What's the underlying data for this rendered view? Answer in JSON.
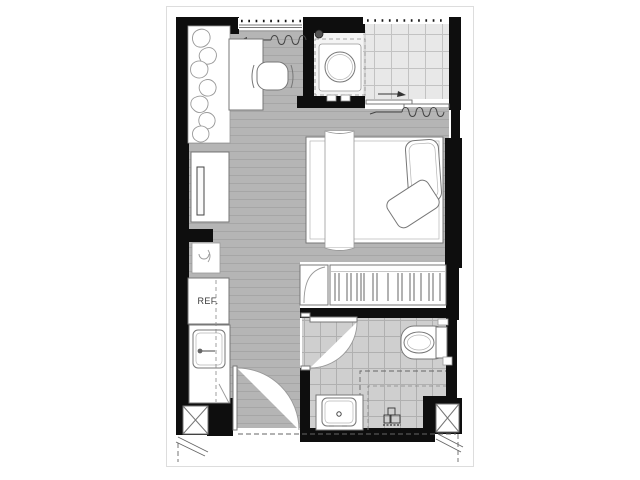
{
  "plan": {
    "ref_label": "REF.",
    "fixtures": [
      "sofa",
      "desk",
      "desk-chair",
      "tv-console",
      "tv-panel",
      "kitchen-cabinet",
      "refrigerator",
      "kitchen-sink-counter",
      "washing-machine",
      "balcony-tiles",
      "bed",
      "pillows",
      "blanket-runner",
      "wardrobe",
      "small-cabinet",
      "bathroom-door",
      "entry-door",
      "toilet",
      "vanity-sink",
      "floor-drain",
      "shower-zone-dashed",
      "sliding-window",
      "curtain-squiggle",
      "column-x-marker",
      "window-dotted-rail"
    ]
  },
  "colors": {
    "wall": "#0e0e0e",
    "floor": "#b5b5b5",
    "floor-line": "#a2a2a2",
    "tile-balcony": "#e8e8e8",
    "tile-balcony-line": "#c2c2c2",
    "tile-bath": "#cfcfcf",
    "tile-bath-line": "#b0b0b0",
    "outline": "#777777",
    "outline-dark": "#444444",
    "sketch": "#999999",
    "frame": "#dddddd"
  }
}
